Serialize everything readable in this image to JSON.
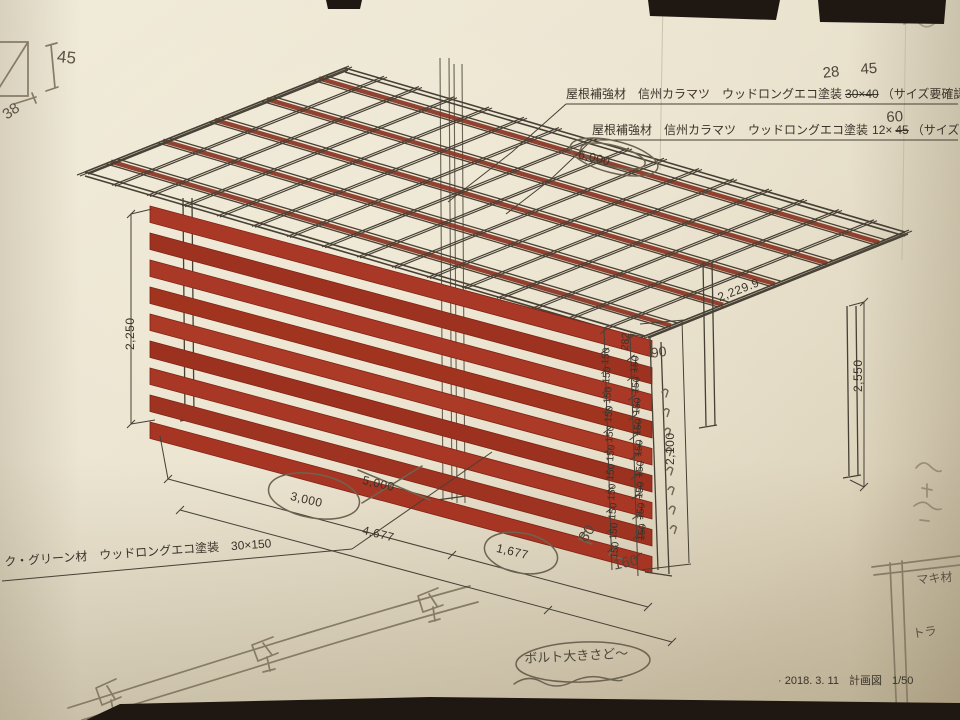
{
  "title_block": {
    "date": "· 2018. 3. 11",
    "doc_type": "計画図",
    "scale": "1/50"
  },
  "annotations": {
    "roof_note_1": {
      "text": "屋根補強材　信州カラマツ　ウッドロングエコ塗装",
      "struck_size": "30×40",
      "note": "（サイズ要確認）",
      "correction_a": "28",
      "correction_b": "45"
    },
    "roof_note_2": {
      "text": "屋根補強材　信州カラマツ　ウッドロングエコ塗装",
      "size_prefix": "12×",
      "struck_size": "45",
      "correction": "60",
      "note": "（サイズ要確認）"
    },
    "deck_note": {
      "text": "ク・グリーン材　ウッドロングエコ塗装　30×150"
    }
  },
  "dimensions": {
    "wall_height_left": "2,250",
    "post_height_right": "2,550",
    "screen_height": "2,100",
    "roof_depth": "2,229.9",
    "roof_length": "6,000",
    "span_circled": "3,000",
    "span_struck": "5,000",
    "deck_length": "4,677",
    "deck_end": "1,677",
    "chain_top": "282"
  },
  "chain": {
    "segments": [
      "150",
      "150",
      "150",
      "150",
      "150",
      "150",
      "150",
      "150",
      "150",
      "150",
      "150"
    ],
    "struck": [
      "150",
      "150",
      "150",
      "150",
      "150",
      "150",
      "150",
      "150",
      "150"
    ]
  },
  "handwritten": {
    "detail_height": "45",
    "detail_width": "38",
    "slat_gap": "90",
    "ditto_repeat_marks": 8,
    "gap_a": "80",
    "gap_b": "160",
    "bolt_note": "ボルト大きさど〜",
    "corner_note_a": "マキ材",
    "corner_note_b": "トラ"
  },
  "colors": {
    "slat_red": "#a63a28",
    "slat_red_dark": "#99321f",
    "paper": "#e6dfca",
    "ink": "#3a332a",
    "pencil": "#867c66"
  }
}
